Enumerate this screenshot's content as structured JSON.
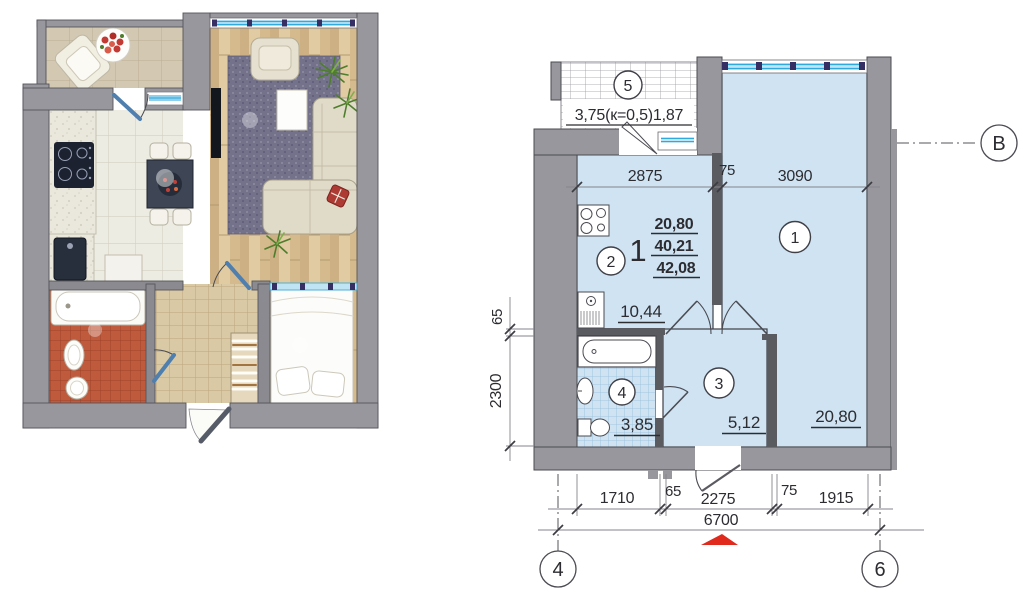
{
  "figure": {
    "type": "apartment-floor-plan",
    "views": [
      "furnished-render",
      "dimensioned-plan"
    ]
  },
  "colors": {
    "wall": "#97979d",
    "partition": "#5a5a61",
    "room_fill": "#cfe3f2",
    "window_blue": "#2fa9de",
    "entry_marker_red": "#e02a1e",
    "bath_tile_red": "#bf5a3d",
    "wood_floor": "#d9c094"
  },
  "plan": {
    "unit": {
      "number": "1",
      "living": "20,80",
      "apartment": "40,21",
      "total": "42,08"
    },
    "rooms": [
      {
        "num": "1",
        "area": "20,80"
      },
      {
        "num": "2",
        "area": "10,44"
      },
      {
        "num": "3",
        "area": "5,12"
      },
      {
        "num": "4",
        "area": "3,85"
      },
      {
        "num": "5",
        "area": "3,75(к=0,5)1,87"
      }
    ],
    "dims": {
      "top": [
        "2875",
        "75",
        "3090"
      ],
      "left": [
        "65",
        "2300"
      ],
      "bottom": [
        "1710",
        "65",
        "2275",
        "75",
        "1915"
      ],
      "total": "6700"
    },
    "axes": {
      "left": "4",
      "right": "6",
      "row": "В"
    }
  }
}
